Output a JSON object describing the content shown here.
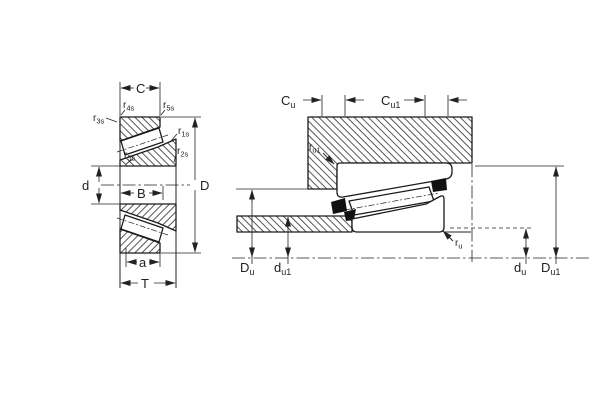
{
  "figure": {
    "description": "tapered-roller-bearing-dimension-and-mounting-diagram"
  },
  "left_view": {
    "dim_labels": {
      "cup_width": "C",
      "bore": "d",
      "outer_diameter": "D",
      "cone_width": "B",
      "load_center": "a",
      "total_width": "T"
    },
    "chamfer_labels": {
      "r3": {
        "main": "r",
        "sub": "3s"
      },
      "r4": {
        "main": "r",
        "sub": "4s"
      },
      "r5_top": {
        "main": "r",
        "sub": "5s"
      },
      "r1": {
        "main": "r",
        "sub": "1s"
      },
      "r2": {
        "main": "r",
        "sub": "2s"
      },
      "r5_inner": {
        "main": "r",
        "sub": "5s"
      }
    }
  },
  "right_view": {
    "dim_labels": {
      "Cu": {
        "main": "C",
        "sub": "u"
      },
      "Cu1": {
        "main": "C",
        "sub": "u1"
      },
      "ru1": {
        "main": "r",
        "sub": "u1"
      },
      "ru": {
        "main": "r",
        "sub": "u"
      },
      "Du": {
        "main": "D",
        "sub": "u"
      },
      "du1": {
        "main": "d",
        "sub": "u1"
      },
      "du": {
        "main": "d",
        "sub": "u"
      },
      "Du1": {
        "main": "D",
        "sub": "u1"
      }
    }
  },
  "colors": {
    "line": "#222222",
    "solid_fill": "#111111",
    "background": "#ffffff"
  }
}
